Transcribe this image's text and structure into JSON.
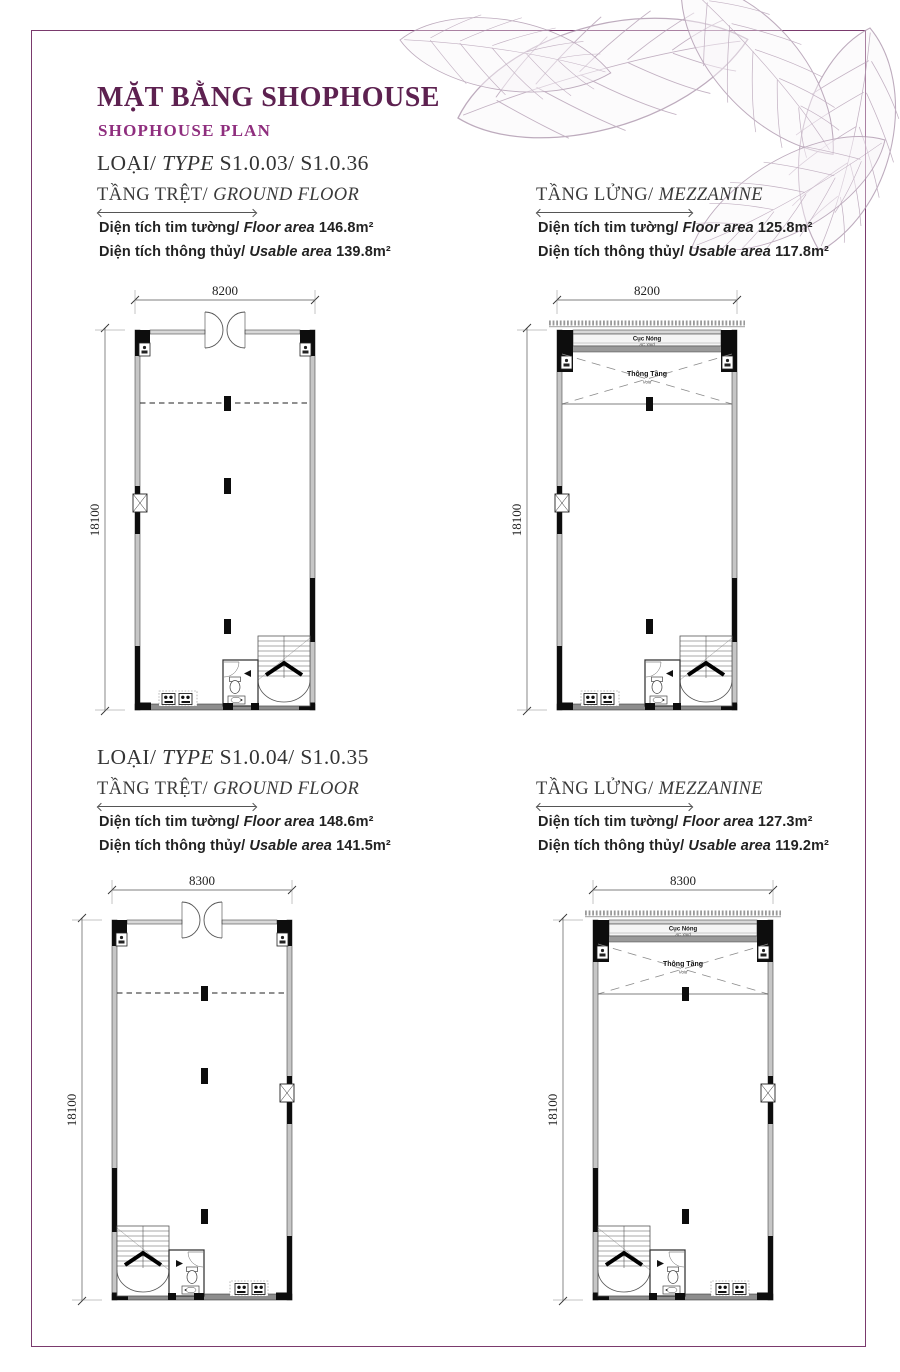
{
  "page": {
    "title": "MẶT BẰNG SHOPHOUSE",
    "subtitle": "SHOPHOUSE PLAN"
  },
  "sections": [
    {
      "type_vi": "LOẠI/",
      "type_en": "TYPE",
      "type_code": "S1.0.03/ S1.0.36",
      "columns": [
        {
          "floor_vi": "TẦNG TRỆT/",
          "floor_en": "GROUND FLOOR",
          "rows": [
            {
              "vi": "Diện tích tim tường/",
              "en": "Floor area",
              "val": "146.8m²"
            },
            {
              "vi": "Diện tích thông thủy/",
              "en": "Usable area",
              "val": "139.8m²"
            }
          ]
        },
        {
          "floor_vi": "TẦNG LỬNG/",
          "floor_en": "MEZZANINE",
          "rows": [
            {
              "vi": "Diện tích tim tường/",
              "en": "Floor area",
              "val": "125.8m²"
            },
            {
              "vi": "Diện tích thông thủy/",
              "en": "Usable area",
              "val": "117.8m²"
            }
          ]
        }
      ]
    },
    {
      "type_vi": "LOẠI/",
      "type_en": "TYPE",
      "type_code": "S1.0.04/ S1.0.35",
      "columns": [
        {
          "floor_vi": "TẦNG TRỆT/",
          "floor_en": "GROUND FLOOR",
          "rows": [
            {
              "vi": "Diện tích tim tường/",
              "en": "Floor area",
              "val": "148.6m²"
            },
            {
              "vi": "Diện tích thông thủy/",
              "en": "Usable area",
              "val": "141.5m²"
            }
          ]
        },
        {
          "floor_vi": "TẦNG LỬNG/",
          "floor_en": "MEZZANINE",
          "rows": [
            {
              "vi": "Diện tích tim tường/",
              "en": "Floor area",
              "val": "127.3m²"
            },
            {
              "vi": "Diện tích thông thủy/",
              "en": "Usable area",
              "val": "119.2m²"
            }
          ]
        }
      ]
    }
  ],
  "plans": [
    {
      "id": "s103-ground",
      "kind": "ground",
      "mirror": false,
      "dim_width": "8200",
      "dim_height": "18100"
    },
    {
      "id": "s103-mezzanine",
      "kind": "mezzanine",
      "mirror": false,
      "dim_width": "8200",
      "dim_height": "18100",
      "ac_label": "Cục Nóng",
      "ac_sub": "AC Yard",
      "void_label": "Thông Tầng",
      "void_sub": "Void"
    },
    {
      "id": "s104-ground",
      "kind": "ground",
      "mirror": true,
      "dim_width": "8300",
      "dim_height": "18100"
    },
    {
      "id": "s104-mezzanine",
      "kind": "mezzanine",
      "mirror": true,
      "dim_width": "8300",
      "dim_height": "18100",
      "ac_label": "Cục Nóng",
      "ac_sub": "AC Yard",
      "void_label": "Thông Tầng",
      "void_sub": "Void"
    }
  ],
  "colors": {
    "accent": "#5d2150",
    "subtitle": "#8f2e7e",
    "border": "#7a3a6d"
  }
}
